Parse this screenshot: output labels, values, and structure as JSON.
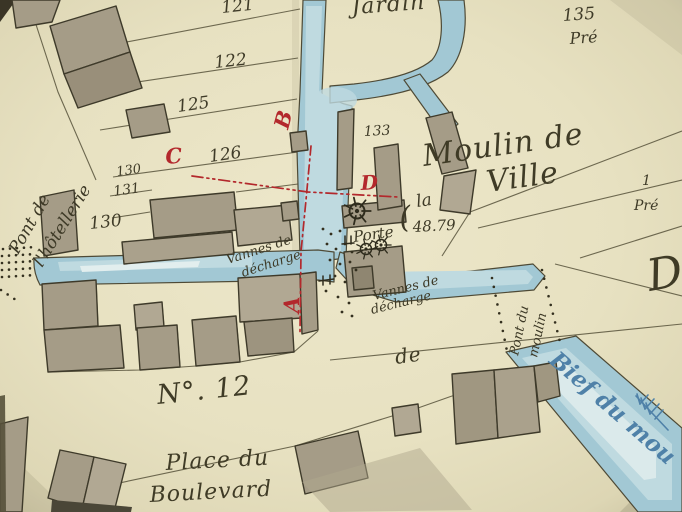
{
  "labels": {
    "jardin": "Jardin",
    "moulin_line1": "Moulin de",
    "moulin_article": "la",
    "moulin_line2": "Ville",
    "paren": "(",
    "elevation": "48.79",
    "porte": "Porte",
    "vannes_west_line1": "Vannes de",
    "vannes_west_line2": "décharge",
    "vannes_east_line1": "Vannes de",
    "vannes_east_line2": "décharge",
    "pont_hotellerie_line1": "Pont de",
    "pont_hotellerie_line2": "l'hôtellerie",
    "pont_moulin_line1": "Pont du",
    "pont_moulin_line2": "moulin",
    "bief": "Bief du mou",
    "street_no": "N°. 12",
    "place_line1": "Place du",
    "place_line2": "Boulevard",
    "street_de": "de",
    "pre_135": "Pré",
    "edge_number": "1",
    "edge_pre": "Pré",
    "edge_letter": "D"
  },
  "parcels": {
    "p121": "121",
    "p122": "122",
    "p125": "125",
    "p126": "126",
    "p130_upper": "130",
    "p131": "131",
    "p130_lower": "130",
    "p133": "133",
    "p135": "135"
  },
  "ref_letters": {
    "a": "A",
    "b": "B",
    "c": "C",
    "d": "D"
  },
  "colors": {
    "paper": "#e7e1c1",
    "water": "#a2c8d4",
    "water_highlight": "#e2eeee",
    "building": "#a59c87",
    "ink": "#3d3926",
    "reference_red": "#b3282c",
    "water_text_blue": "#4f81a8"
  }
}
